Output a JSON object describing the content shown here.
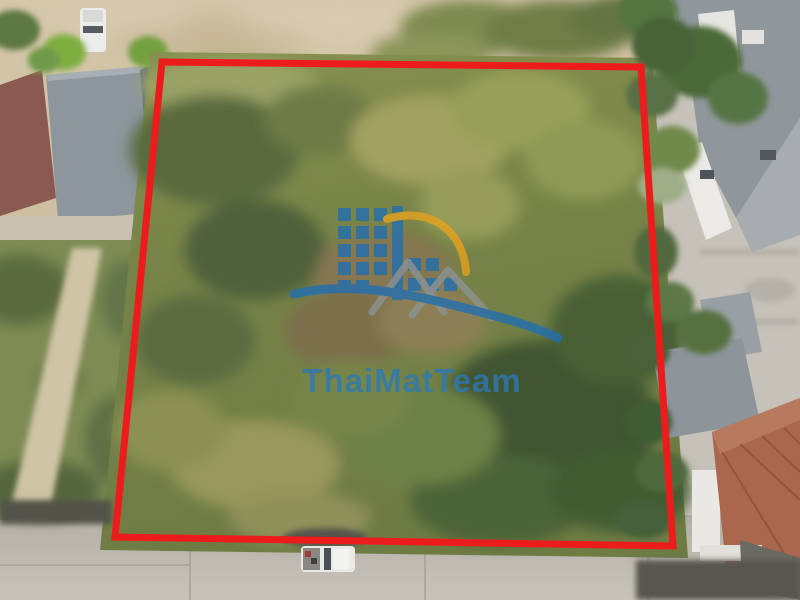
{
  "scene": {
    "type": "aerial-drone-photo",
    "subject": "vacant-land-plot-outlined-in-red"
  },
  "boundary": {
    "color": "#ed1c1c",
    "stroke_width": 7,
    "points": "162,62 641,67 673,546 115,537"
  },
  "watermark": {
    "text": "ThaiMatTeam",
    "text_color": "#2b79b6",
    "opacity": 0.78,
    "logo": {
      "building_color": "#1f6fb3",
      "arc_color": "#e8a31e",
      "roof_color": "#8e98a2",
      "wave_color": "#1f6fb3"
    }
  }
}
